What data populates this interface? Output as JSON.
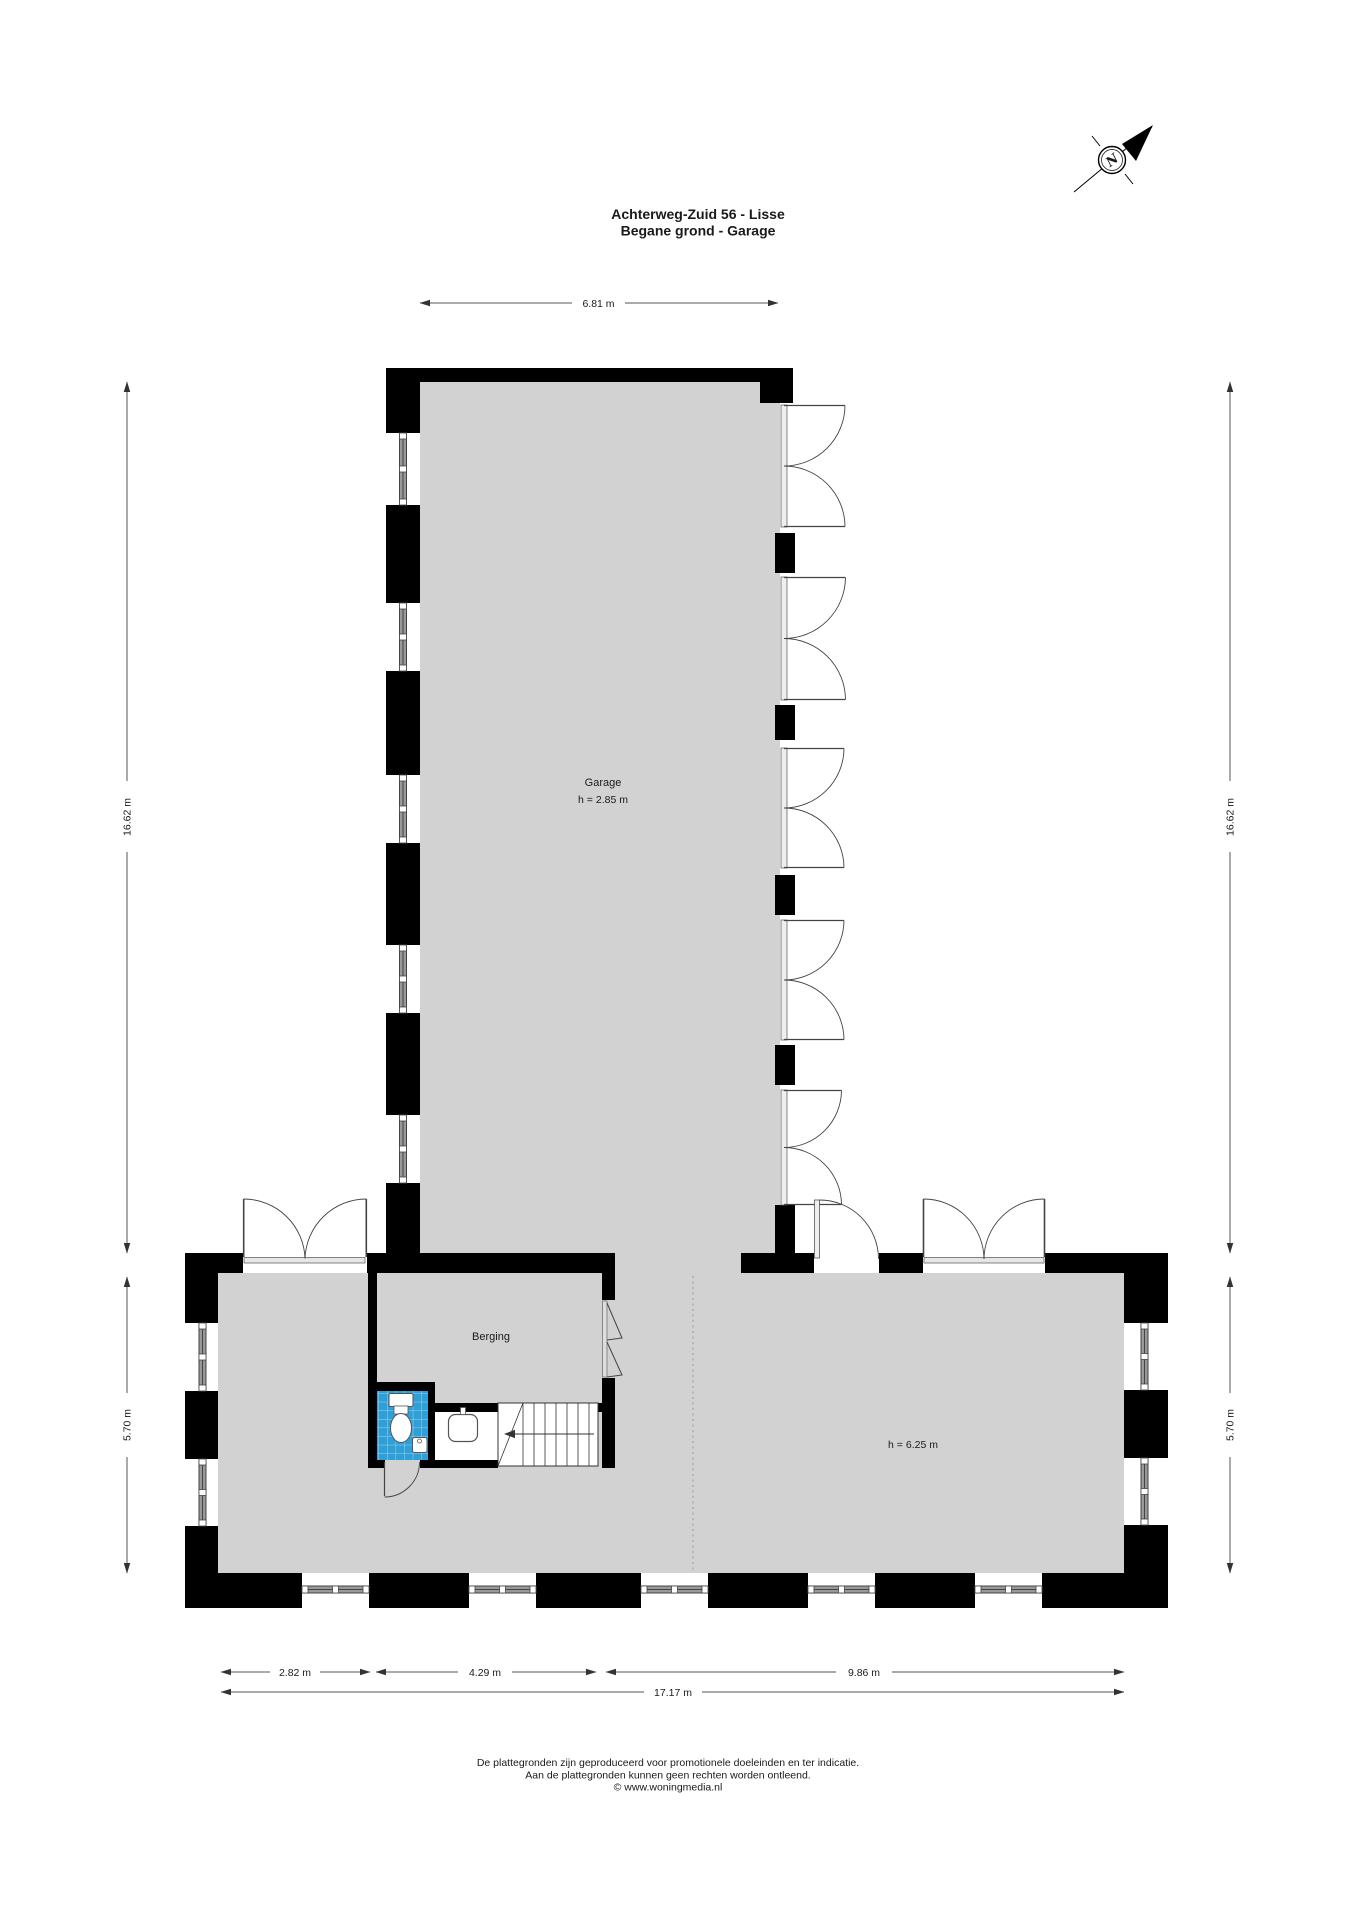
{
  "title": {
    "line1": "Achterweg-Zuid 56 - Lisse",
    "line2": "Begane grond - Garage"
  },
  "compass": {
    "north_label": "N"
  },
  "rooms": {
    "garage": {
      "name": "Garage",
      "ceiling": "h = 2.85 m"
    },
    "berging": {
      "name": "Berging"
    },
    "hall": {
      "ceiling": "h = 6.25 m"
    }
  },
  "dimensions": {
    "garage_width": "6.81 m",
    "garage_depth_left": "16.62 m",
    "garage_depth_right": "16.62 m",
    "lower_depth_left": "5.70 m",
    "lower_depth_right": "5.70 m",
    "bottom_segment_1": "2.82 m",
    "bottom_segment_2": "4.29 m",
    "bottom_segment_3": "9.86 m",
    "bottom_total": "17.17 m"
  },
  "footer": {
    "line1": "De plattegronden zijn geproduceerd voor promotionele doeleinden en ter indicatie.",
    "line2": "Aan de plattegronden kunnen geen rechten worden ontleend.",
    "line3": "© www.woningmedia.nl"
  },
  "colors": {
    "wall": "#000000",
    "floor": "#d2d2d2",
    "tiles": "#2f9fd8",
    "tile_grid": "#9fd4ec",
    "line": "#444444"
  }
}
